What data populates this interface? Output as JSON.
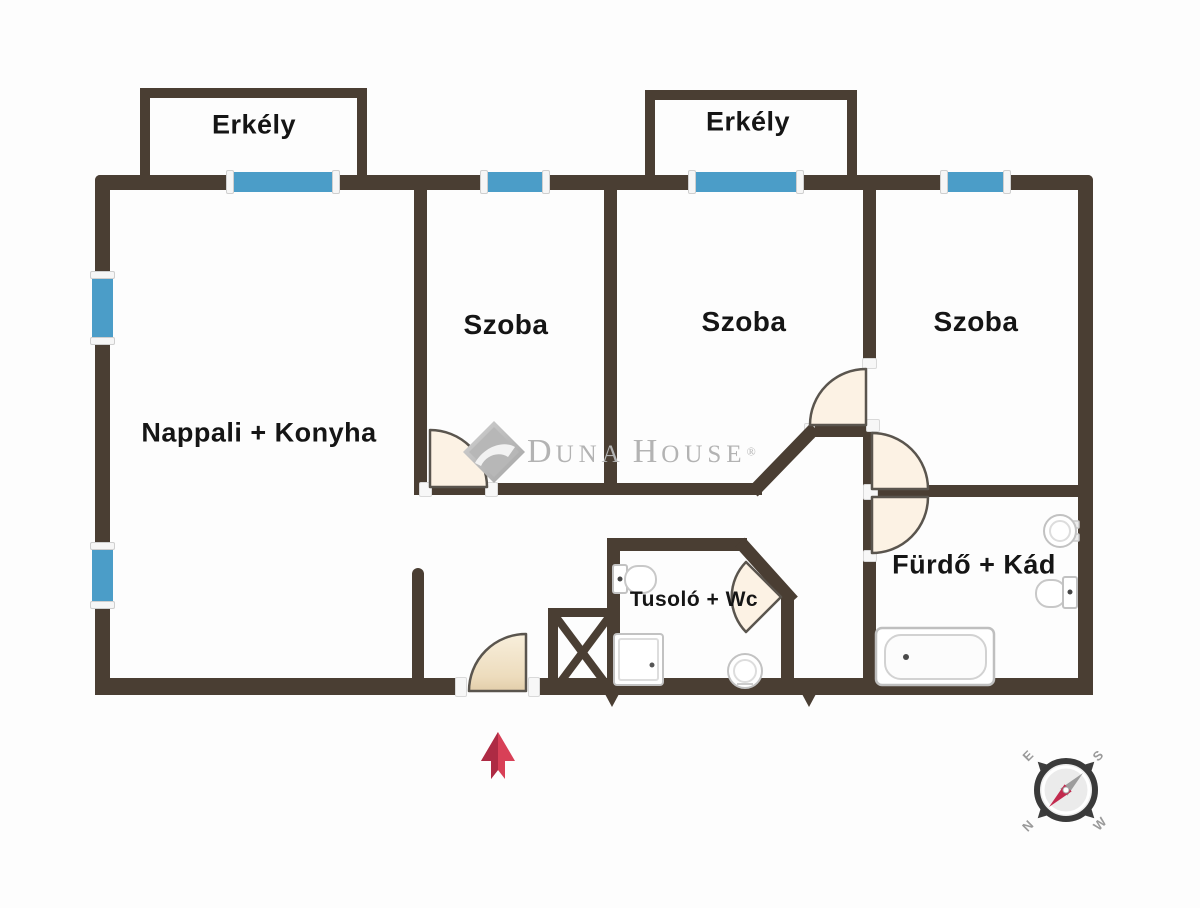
{
  "balconies": [
    {
      "label": "Erkély"
    },
    {
      "label": "Erkély"
    }
  ],
  "rooms": [
    {
      "name": "nappali-konyha",
      "label": "Nappali + Konyha"
    },
    {
      "name": "szoba-1",
      "label": "Szoba"
    },
    {
      "name": "szoba-2",
      "label": "Szoba"
    },
    {
      "name": "szoba-3",
      "label": "Szoba"
    },
    {
      "name": "tusolo-wc",
      "label": "Tusoló + Wc"
    },
    {
      "name": "furdo-kad",
      "label": "Fürdő + Kád"
    }
  ],
  "watermark": {
    "word1_initial": "D",
    "word1_rest": "UNA",
    "word2_initial": "H",
    "word2_rest": "OUSE",
    "registered": "®"
  },
  "compass": {
    "north": "N",
    "south": "S",
    "east": "E",
    "west": "W"
  },
  "colors": {
    "wall": "#4a3e33",
    "window": "#4b9dc8",
    "door_swing_fill": "#fcf2e4",
    "entrance_door_fill": "#ecdec4",
    "arrow_red": "#d84057",
    "arrow_red_dark": "#ad2b44",
    "logo_gray": "#b3b3b3",
    "compass_needle_red": "#c22a4e",
    "compass_needle_gray": "#9c9c9c"
  }
}
